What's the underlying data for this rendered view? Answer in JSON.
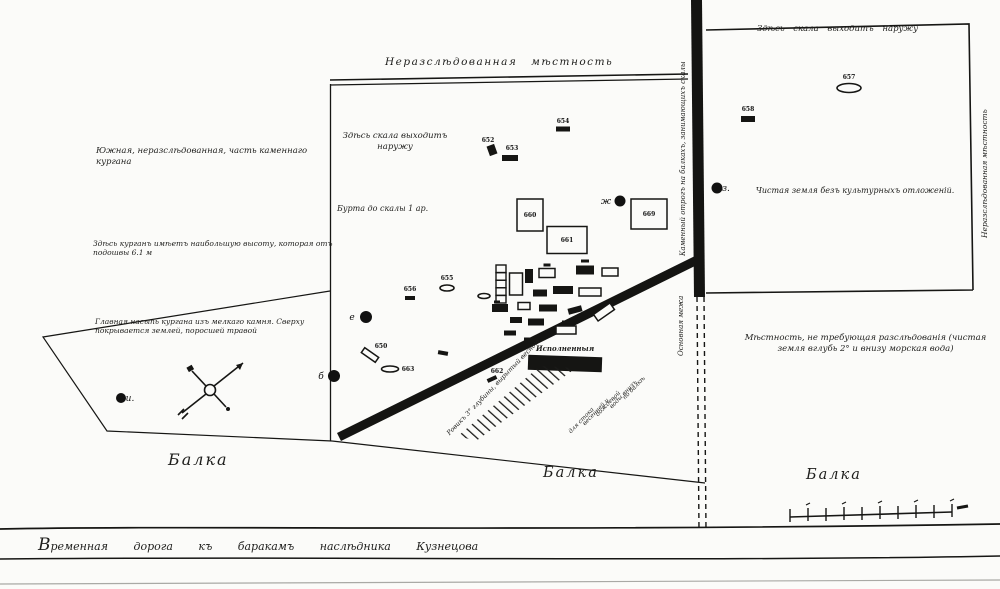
{
  "notes": {
    "unexplored_top": "Неразслѣдованная мѣстность",
    "rock_outcrop_center": "Здѣсь скала выходитъ наружу",
    "rock_outcrop_right": "Здѣсь скала выходитъ наружу",
    "unexplored_right_vertical": "Неразслѣдованная мѣстность",
    "southern_part": "Южная, неразслѣдованная, часть каменнаго кургана",
    "depth_to_rock": "Бурта до скалы 1 ар.",
    "greatest_height": "Здѣсь курганъ имѣетъ наибольшую высоту, которая отъ подошвы 6.1 м",
    "mound_fill": "Главная насыпь кургана изъ мелкаго камня. Сверху покрывается землей, поросшей травой",
    "clean_soil": "Чистая земля безъ культурныхъ отложеній.",
    "no_research": "Мѣстность, не требующая разслѣдованія (чистая земля вглубь 2° и внизу морская вода)",
    "ridge_vertical_upper": "Каменный отрогъ на балкахъ, занимающихъ скалы",
    "ridge_vertical_lower": "Основная межа",
    "trench_caption": "Исполненныя",
    "trench_left": "Ровикъ 3° глубины, вырытый весною",
    "road": "Временная дорога къ баракамъ наслѣдника Кузнецова",
    "balka_left": "Балка",
    "balka_center": "Балка",
    "balka_right": "Балка"
  },
  "trench_right_lines": [
    "для стока",
    "весенней и",
    "дождевой",
    "воды внизъ",
    "по балкѣ"
  ],
  "features": [
    {
      "id": "654",
      "t": "filled",
      "x": 563,
      "y": 129,
      "w": 14,
      "h": 5,
      "label": "654",
      "lx": 563,
      "ly": 123
    },
    {
      "id": "652",
      "t": "filled",
      "x": 492,
      "y": 150,
      "w": 8,
      "h": 10,
      "rot": -20,
      "label": "652",
      "lx": 488,
      "ly": 142
    },
    {
      "id": "653",
      "t": "filled",
      "x": 510,
      "y": 158,
      "w": 16,
      "h": 6,
      "label": "653",
      "lx": 512,
      "ly": 150
    },
    {
      "id": "657",
      "t": "oval-outline",
      "x": 849,
      "y": 88,
      "w": 24,
      "h": 9,
      "label": "657",
      "lx": 849,
      "ly": 79
    },
    {
      "id": "658",
      "t": "filled",
      "x": 748,
      "y": 119,
      "w": 14,
      "h": 6,
      "label": "658",
      "lx": 748,
      "ly": 111
    },
    {
      "id": "660",
      "t": "rect-outline",
      "x": 530,
      "y": 215,
      "w": 26,
      "h": 32,
      "label": "660",
      "inside": true
    },
    {
      "id": "661",
      "t": "rect-outline",
      "x": 567,
      "y": 240,
      "w": 40,
      "h": 27,
      "label": "661",
      "inside": true
    },
    {
      "id": "669",
      "t": "rect-outline",
      "x": 649,
      "y": 214,
      "w": 36,
      "h": 30,
      "label": "669",
      "inside": true
    },
    {
      "id": "dot-zh",
      "t": "dot",
      "x": 620,
      "y": 201,
      "r": 5.5,
      "label": "ж",
      "lx": 606,
      "ly": 204,
      "letter": true
    },
    {
      "id": "dot-z",
      "t": "dot",
      "x": 717,
      "y": 188,
      "r": 5.5,
      "label": "з.",
      "lx": 726,
      "ly": 191,
      "letter": true
    },
    {
      "id": "dot-e",
      "t": "dot",
      "x": 366,
      "y": 317,
      "r": 6,
      "label": "е",
      "lx": 352,
      "ly": 320,
      "letter": true
    },
    {
      "id": "dot-b",
      "t": "dot",
      "x": 334,
      "y": 376,
      "r": 6,
      "label": "б",
      "lx": 321,
      "ly": 379,
      "letter": true
    },
    {
      "id": "dot-i",
      "t": "dot",
      "x": 121,
      "y": 398,
      "r": 5,
      "label": "и.",
      "lx": 130,
      "ly": 401,
      "letter": true
    },
    {
      "id": "655",
      "t": "oval-outline",
      "x": 447,
      "y": 288,
      "w": 14,
      "h": 6,
      "label": "655",
      "lx": 447,
      "ly": 280
    },
    {
      "id": "656",
      "t": "filled",
      "x": 410,
      "y": 298,
      "w": 10,
      "h": 4,
      "label": "656",
      "lx": 410,
      "ly": 291
    },
    {
      "id": "650",
      "t": "rect-outline",
      "x": 370,
      "y": 355,
      "w": 17,
      "h": 6,
      "rot": 35,
      "label": "650",
      "lx": 381,
      "ly": 348
    },
    {
      "id": "663",
      "t": "oval-outline",
      "x": 390,
      "y": 369,
      "w": 17,
      "h": 6,
      "label": "663",
      "lx": 408,
      "ly": 371
    },
    {
      "id": "662",
      "t": "filled",
      "x": 492,
      "y": 379,
      "w": 10,
      "h": 4,
      "rot": -25,
      "label": "662",
      "lx": 497,
      "ly": 373
    },
    {
      "id": "mark-a",
      "t": "filled",
      "x": 443,
      "y": 353,
      "w": 10,
      "h": 4,
      "rot": 10
    },
    {
      "t": "ladder",
      "x": 501,
      "y": 284,
      "w": 10,
      "h": 38
    },
    {
      "t": "rect-outline",
      "x": 516,
      "y": 284,
      "w": 13,
      "h": 22
    },
    {
      "t": "filled",
      "x": 529,
      "y": 276,
      "w": 8,
      "h": 14
    },
    {
      "t": "rect-outline",
      "x": 547,
      "y": 273,
      "w": 16,
      "h": 9
    },
    {
      "t": "mark",
      "x": 547,
      "y": 265,
      "w": 7,
      "h": 3
    },
    {
      "t": "filled",
      "x": 585,
      "y": 270,
      "w": 18,
      "h": 9
    },
    {
      "t": "mark",
      "x": 585,
      "y": 261,
      "w": 8,
      "h": 3
    },
    {
      "t": "rect-outline",
      "x": 610,
      "y": 272,
      "w": 16,
      "h": 8
    },
    {
      "t": "filled",
      "x": 563,
      "y": 290,
      "w": 20,
      "h": 8
    },
    {
      "t": "rect-outline",
      "x": 590,
      "y": 292,
      "w": 22,
      "h": 8
    },
    {
      "t": "filled",
      "x": 540,
      "y": 293,
      "w": 14,
      "h": 7
    },
    {
      "t": "oval-outline",
      "x": 484,
      "y": 296,
      "w": 12,
      "h": 5
    },
    {
      "t": "mark",
      "x": 497,
      "y": 302,
      "w": 6,
      "h": 3
    },
    {
      "t": "filled",
      "x": 500,
      "y": 308,
      "w": 16,
      "h": 8
    },
    {
      "t": "rect-outline",
      "x": 524,
      "y": 306,
      "w": 12,
      "h": 7
    },
    {
      "t": "filled",
      "x": 548,
      "y": 308,
      "w": 18,
      "h": 7
    },
    {
      "t": "filled",
      "x": 575,
      "y": 310,
      "w": 14,
      "h": 6,
      "rot": -15
    },
    {
      "t": "rect-outline",
      "x": 604,
      "y": 312,
      "w": 20,
      "h": 8,
      "rot": -35
    },
    {
      "t": "filled",
      "x": 516,
      "y": 320,
      "w": 12,
      "h": 6
    },
    {
      "t": "filled",
      "x": 536,
      "y": 322,
      "w": 16,
      "h": 7
    },
    {
      "t": "rect-outline",
      "x": 566,
      "y": 330,
      "w": 20,
      "h": 8
    },
    {
      "t": "mark",
      "x": 566,
      "y": 322,
      "w": 8,
      "h": 3
    },
    {
      "t": "filled",
      "x": 510,
      "y": 333,
      "w": 12,
      "h": 5
    },
    {
      "t": "filled",
      "x": 531,
      "y": 340,
      "w": 14,
      "h": 5
    }
  ]
}
